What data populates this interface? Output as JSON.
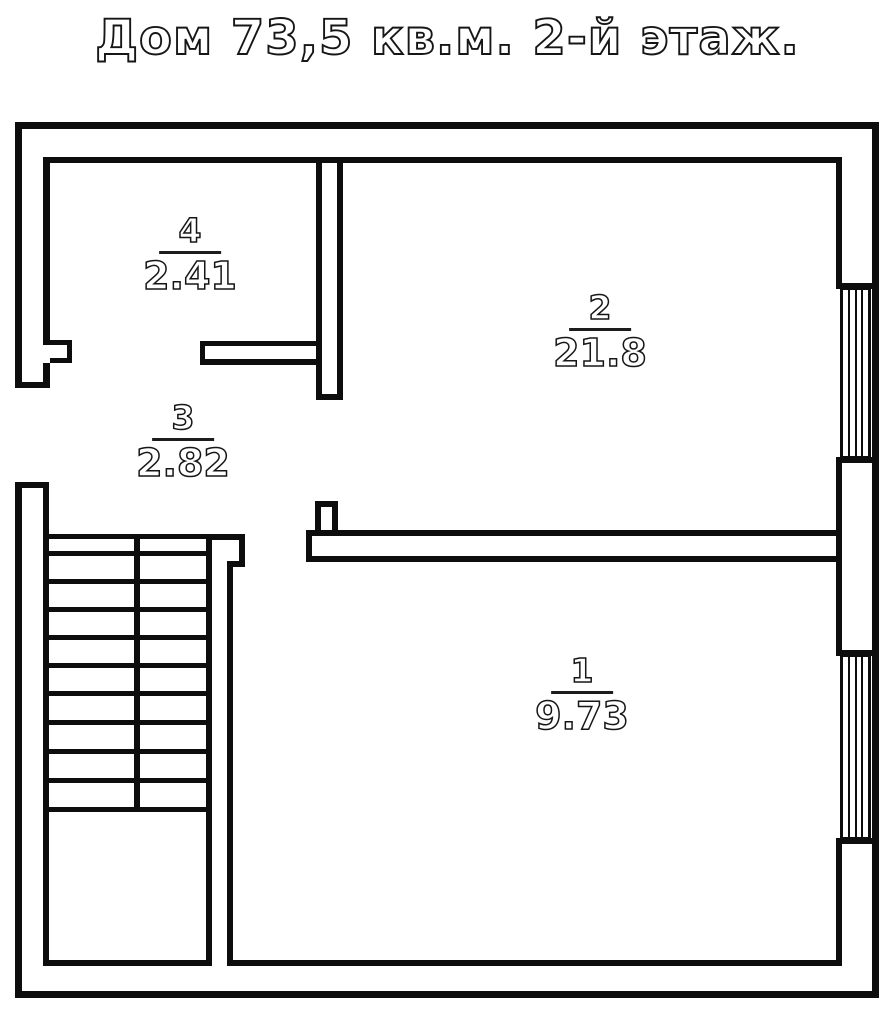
{
  "title": "Дом 73,5 кв.м. 2-й этаж.",
  "rooms": [
    {
      "number": "1",
      "area": "9.73"
    },
    {
      "number": "2",
      "area": "21.8"
    },
    {
      "number": "3",
      "area": "2.82"
    },
    {
      "number": "4",
      "area": "2.41"
    }
  ],
  "colors": {
    "wall": "#0d0d0d",
    "background": "#ffffff"
  }
}
